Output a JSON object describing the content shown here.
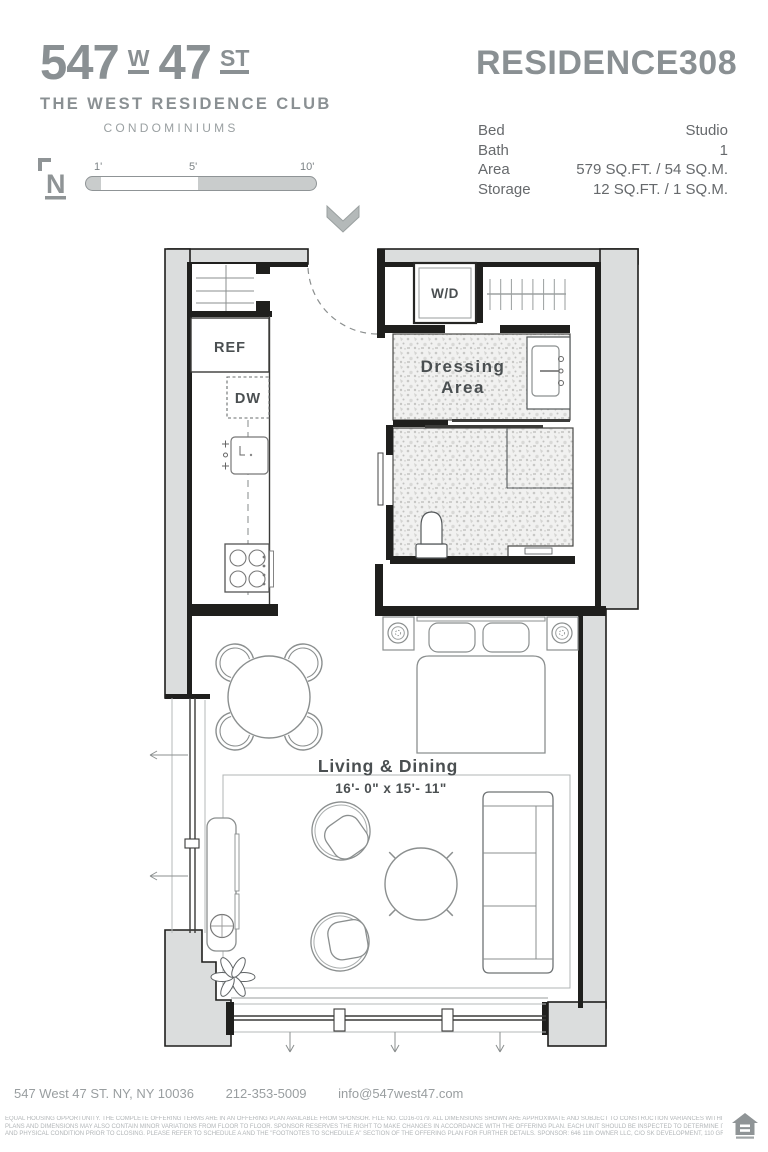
{
  "colors": {
    "brand_gray": "#8a9093",
    "wall_fill": "#dbdddd",
    "plan_line": "#1f1f1d"
  },
  "header": {
    "logo": {
      "num1": "547",
      "w": "W",
      "num2": "47",
      "st": "ST"
    },
    "building_name": "THE WEST RESIDENCE CLUB",
    "building_type": "CONDOMINIUMS",
    "north_label": "N",
    "scale": {
      "t1": "1'",
      "t5": "5'",
      "t10": "10'"
    }
  },
  "residence": {
    "title": "RESIDENCE",
    "number": "308",
    "specs": [
      {
        "label": "Bed",
        "value": "Studio"
      },
      {
        "label": "Bath",
        "value": "1"
      },
      {
        "label": "Area",
        "value": "579 SQ.FT. / 54 SQ.M."
      },
      {
        "label": "Storage",
        "value": "12 SQ.FT. / 1 SQ.M."
      }
    ]
  },
  "plan": {
    "labels": {
      "wd": "W/D",
      "ref": "REF",
      "dw": "DW",
      "dressing_line1": "Dressing",
      "dressing_line2": "Area",
      "living_title": "Living & Dining",
      "living_dims": "16'- 0\" x 15'- 11\""
    }
  },
  "footer": {
    "address": "547 West 47 ST. NY, NY 10036",
    "phone": "212-353-5009",
    "email": "info@547west47.com",
    "legal_line1": "EQUAL HOUSING OPPORTUNITY. THE COMPLETE OFFERING TERMS ARE IN AN OFFERING PLAN AVAILABLE FROM SPONSOR. FILE NO. CD16-0179. ALL DIMENSIONS SHOWN ARE APPROXIMATE AND SUBJECT TO CONSTRUCTION VARIANCES WITHIN REASONABLE TOLERANCES.",
    "legal_line2": "PLANS AND DIMENSIONS MAY ALSO CONTAIN MINOR VARIATIONS FROM FLOOR TO FLOOR. SPONSOR RESERVES THE RIGHT TO MAKE CHANGES IN ACCORDANCE WITH THE OFFERING PLAN. EACH UNIT SHOULD BE INSPECTED TO DETERMINE ITS ACTUAL DIMENSIONS, LAYOUT",
    "legal_line3": "AND PHYSICAL CONDITION PRIOR TO CLOSING. PLEASE REFER TO SCHEDULE A AND THE \"FOOTNOTES TO SCHEDULE A\" SECTION OF THE OFFERING PLAN FOR FURTHER DETAILS. SPONSOR: 646 11th OWNER LLC, C/O SK DEVELOPMENT, 110 GREENE STREET, 901, NEW YORK, NY 10012."
  }
}
